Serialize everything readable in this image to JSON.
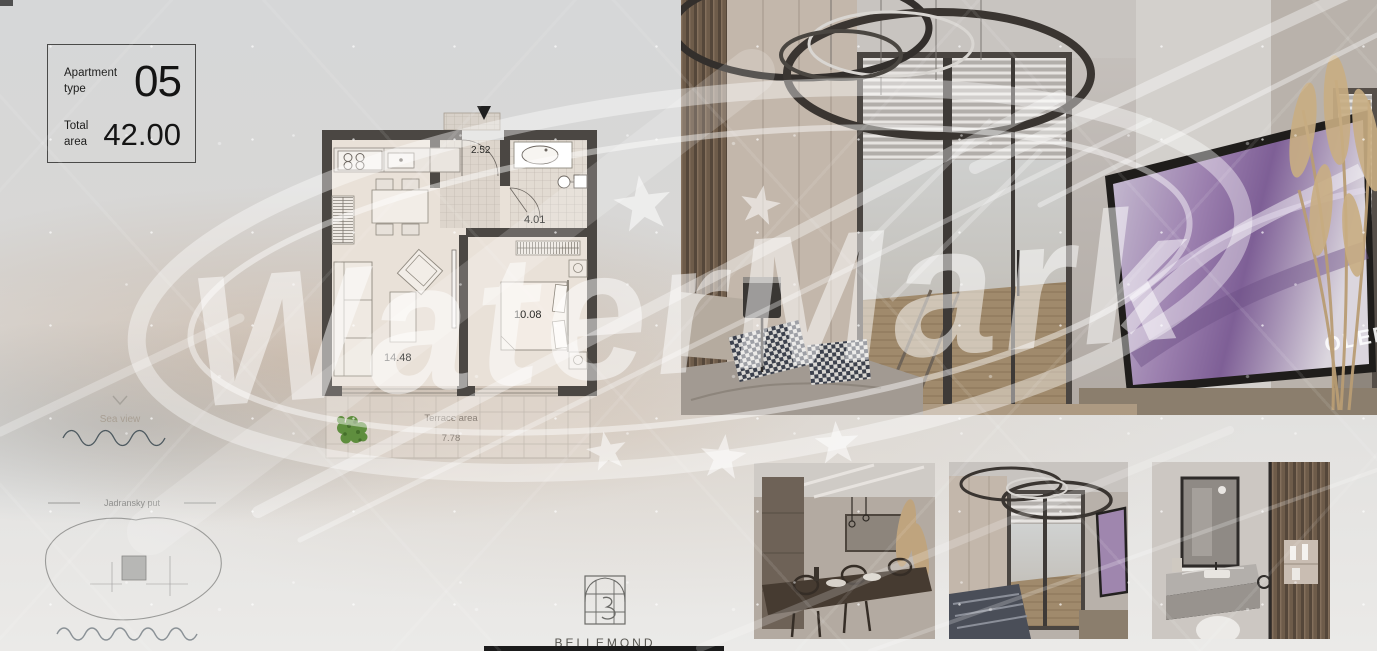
{
  "info_box": {
    "type_label": "Apartment type",
    "type_value": "05",
    "area_label": "Total area",
    "area_value": "42.00"
  },
  "floorplan": {
    "areas": {
      "hall": "2.52",
      "bathroom": "4.01",
      "bedroom": "10.08",
      "living_kitchen": "14.48"
    },
    "terrace": {
      "label": "Terrace area",
      "area": "7.78"
    },
    "entrance_icon": "entrance-arrow",
    "tree_icon": "terrace-tree"
  },
  "annotations": {
    "sea_view_label": "Sea view",
    "road_label": "Jadransky put"
  },
  "brand": {
    "name": "BELLEMOND",
    "tagline": "Residence Montenegro",
    "logo_icon": "arch-window-monogram"
  },
  "watermark": {
    "text": "WaterMark",
    "color": "#ffffff"
  },
  "photos": {
    "main": "bedroom-interior-render",
    "tv_screen_text": "OLED",
    "thumbnails": [
      "dining-area-render",
      "bedroom-terrace-render",
      "bathroom-render"
    ]
  },
  "colors": {
    "wall_dark": "#4b4743",
    "background": "#d7d8d9",
    "tree_green": "#5f8e3e",
    "wave_slate": "#4e5a60"
  }
}
